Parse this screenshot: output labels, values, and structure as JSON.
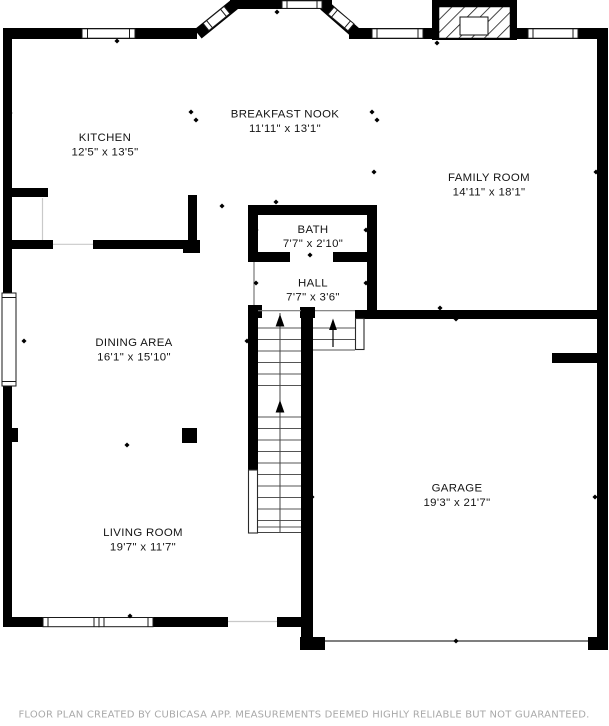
{
  "plan": {
    "footer": "FLOOR PLAN CREATED BY CUBICASA APP. MEASUREMENTS DEEMED HIGHLY RELIABLE BUT NOT GUARANTEED.",
    "colors": {
      "wall": "#000000",
      "background": "#ffffff",
      "tread_line": "#555555",
      "opening_line": "#c9c9c9",
      "footer_text": "#a9a9a9",
      "label_text": "#141414"
    },
    "rooms": [
      {
        "id": "kitchen",
        "name": "KITCHEN",
        "dims": "12'5\" x 13'5\""
      },
      {
        "id": "breakfast-nook",
        "name": "BREAKFAST NOOK",
        "dims": "11'11\" x 13'1\""
      },
      {
        "id": "family-room",
        "name": "FAMILY ROOM",
        "dims": "14'11\" x 18'1\""
      },
      {
        "id": "bath",
        "name": "BATH",
        "dims": "7'7\" x 2'10\""
      },
      {
        "id": "hall",
        "name": "HALL",
        "dims": "7'7\" x 3'6\""
      },
      {
        "id": "dining-area",
        "name": "DINING AREA",
        "dims": "16'1\" x 15'10\""
      },
      {
        "id": "living-room",
        "name": "LIVING ROOM",
        "dims": "19'7\" x 11'7\""
      },
      {
        "id": "garage",
        "name": "GARAGE",
        "dims": "19'3\" x 21'7\""
      }
    ]
  }
}
